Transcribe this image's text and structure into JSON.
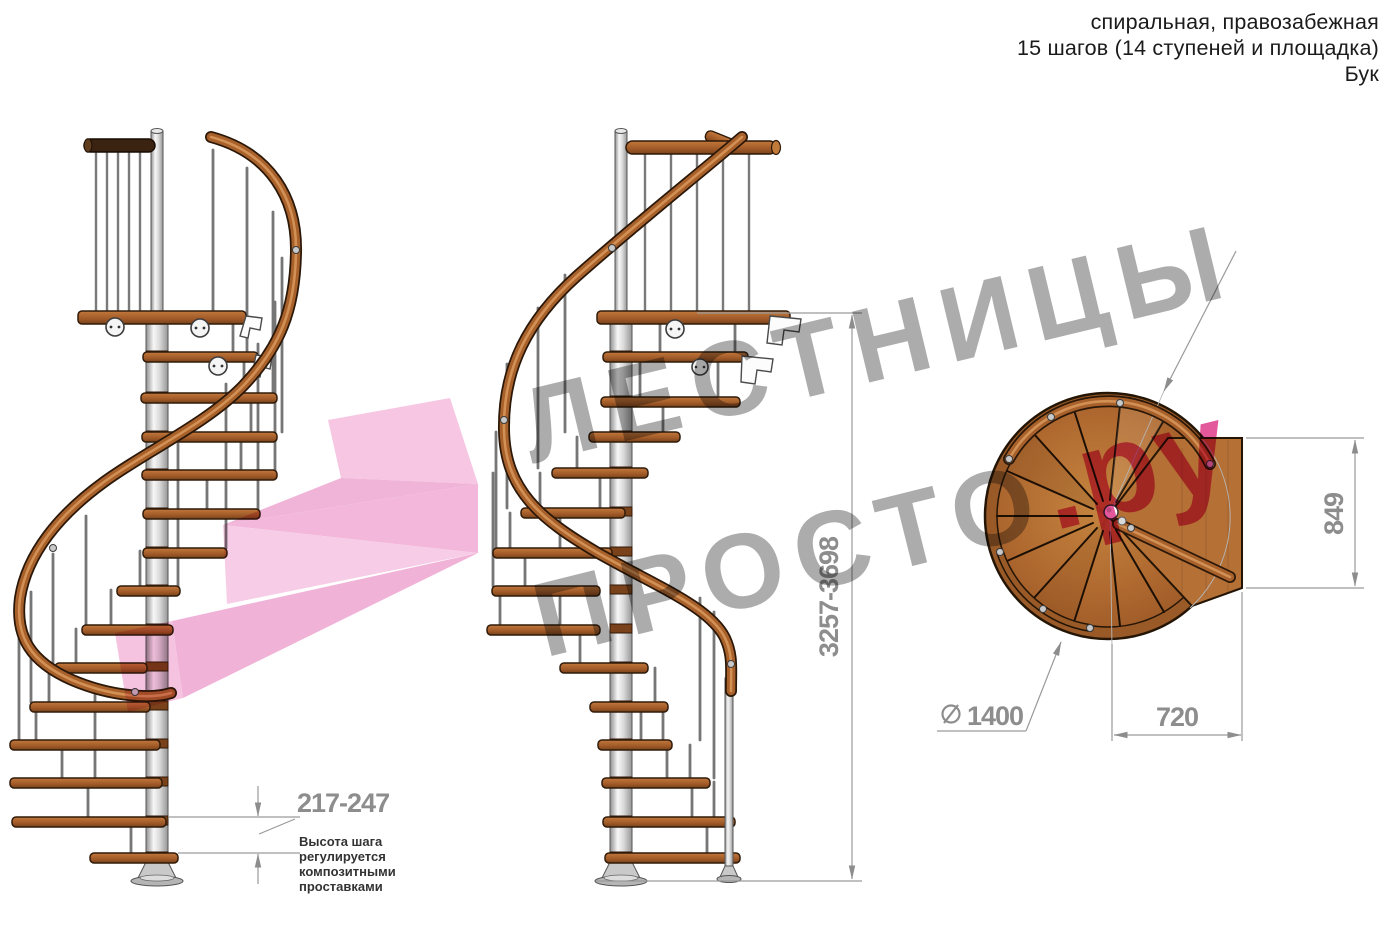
{
  "title_block": {
    "line1": "спиральная, правозабежная",
    "line2": "15 шагов (14 ступеней и площадка)",
    "line3": "Бук"
  },
  "watermark": {
    "word1": "ЛЕСТНИЦЫ",
    "word2": "ПРОСТО",
    "suffix": ".ру",
    "gray": "#a5a5a5",
    "pink": "#e04a91",
    "arrow_pink": "#f2b3d8"
  },
  "dimensions": {
    "total_height": {
      "label": "3257-3698"
    },
    "step_height": {
      "label": "217-247"
    },
    "landing_depth": {
      "label": "849"
    },
    "landing_width": {
      "label": "720"
    },
    "diameter": {
      "symbol": "∅",
      "value": "1400"
    }
  },
  "step_note": {
    "line1": "Высота шага",
    "line2": "регулируется",
    "line3": "композитными",
    "line4": "проставками"
  },
  "colors": {
    "wood": "#a85d28",
    "rail_wood": "#a8612b",
    "dark_outline": "#241505",
    "pole_metal": "#dcdcdc",
    "dim_line": "#9a9a9a",
    "dim_text": "#8d8d8d",
    "note_text": "#333333"
  }
}
